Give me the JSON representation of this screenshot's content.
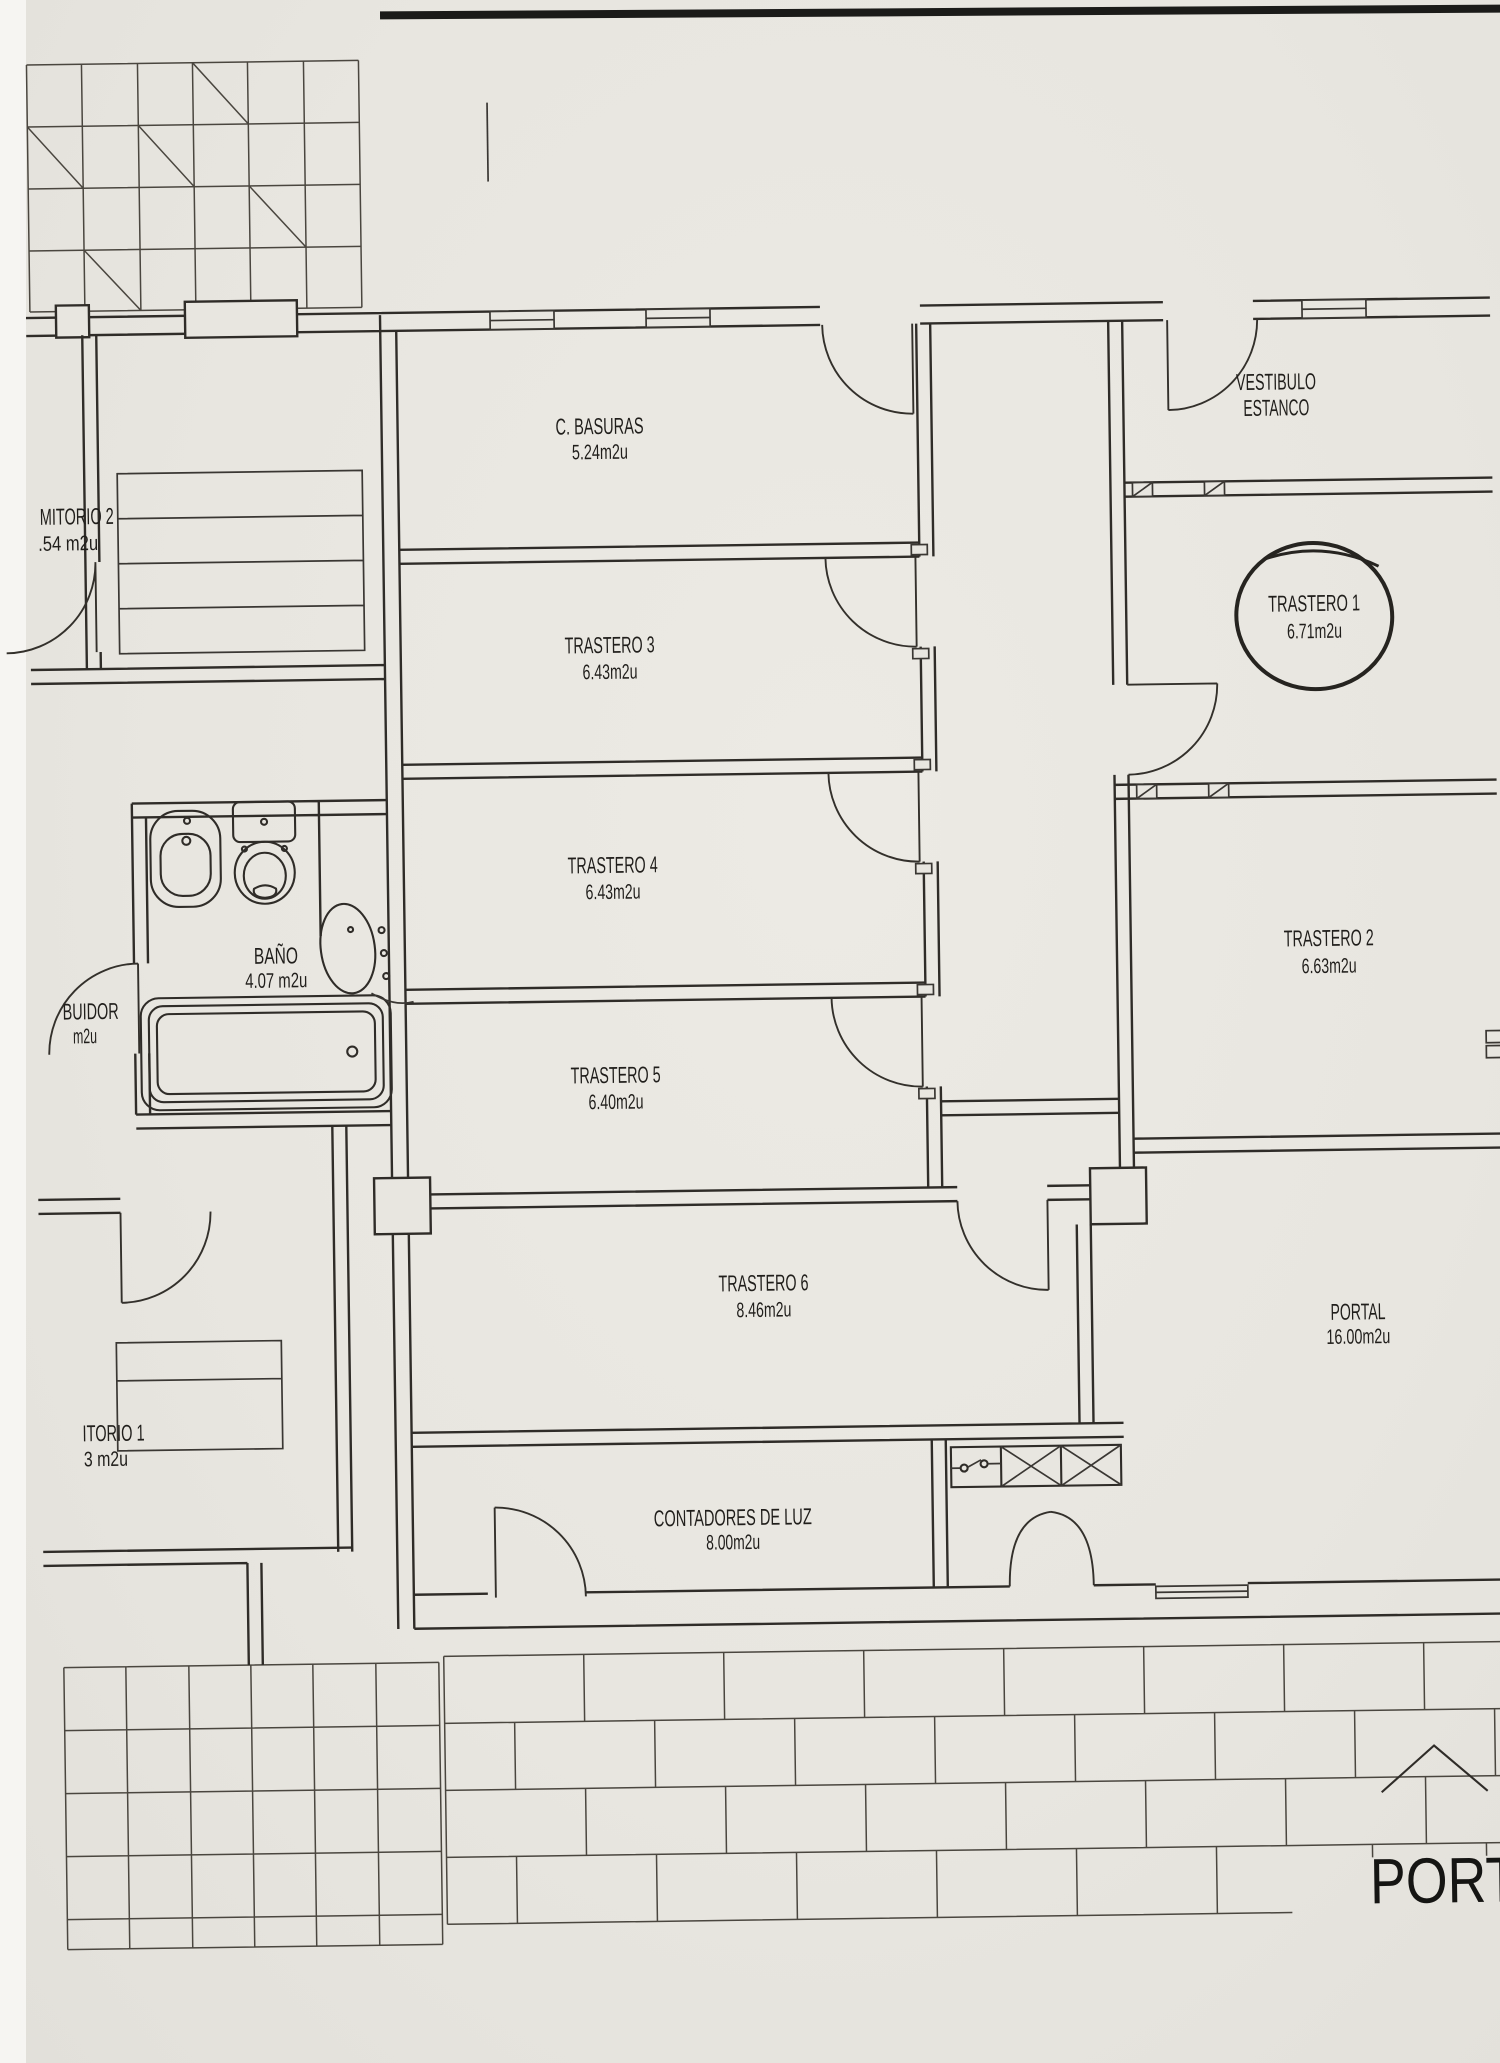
{
  "palette": {
    "paper": "#e8e6e0",
    "ink": "#2f2c28",
    "scan_edge": "#1b1b19"
  },
  "plan": {
    "big_label": "PORTAL",
    "rooms": [
      {
        "label": "C. BASURAS",
        "area": "5.24m2u"
      },
      {
        "label": "VESTIBULO",
        "area": "ESTANCO"
      },
      {
        "label": "MITORIO 2",
        "area": ".54 m2u"
      },
      {
        "label": "TRASTERO 3",
        "area": "6.43m2u"
      },
      {
        "label": "TRASTERO 1",
        "area": "6.71m2u"
      },
      {
        "label": "TRASTERO 4",
        "area": "6.43m2u"
      },
      {
        "label": "BAÑO",
        "area": "4.07 m2u"
      },
      {
        "label": "TRASTERO 2",
        "area": "6.63m2u"
      },
      {
        "label": "BUIDOR",
        "area": "m2u"
      },
      {
        "label": "TRASTERO 5",
        "area": "6.40m2u"
      },
      {
        "label": "TRASTERO 6",
        "area": "8.46m2u"
      },
      {
        "label": "PORTAL",
        "area": "16.00m2u"
      },
      {
        "label": "ITORIO 1",
        "area": "3 m2u"
      },
      {
        "label": "CONTADORES DE LUZ",
        "area": "8.00m2u"
      }
    ]
  }
}
